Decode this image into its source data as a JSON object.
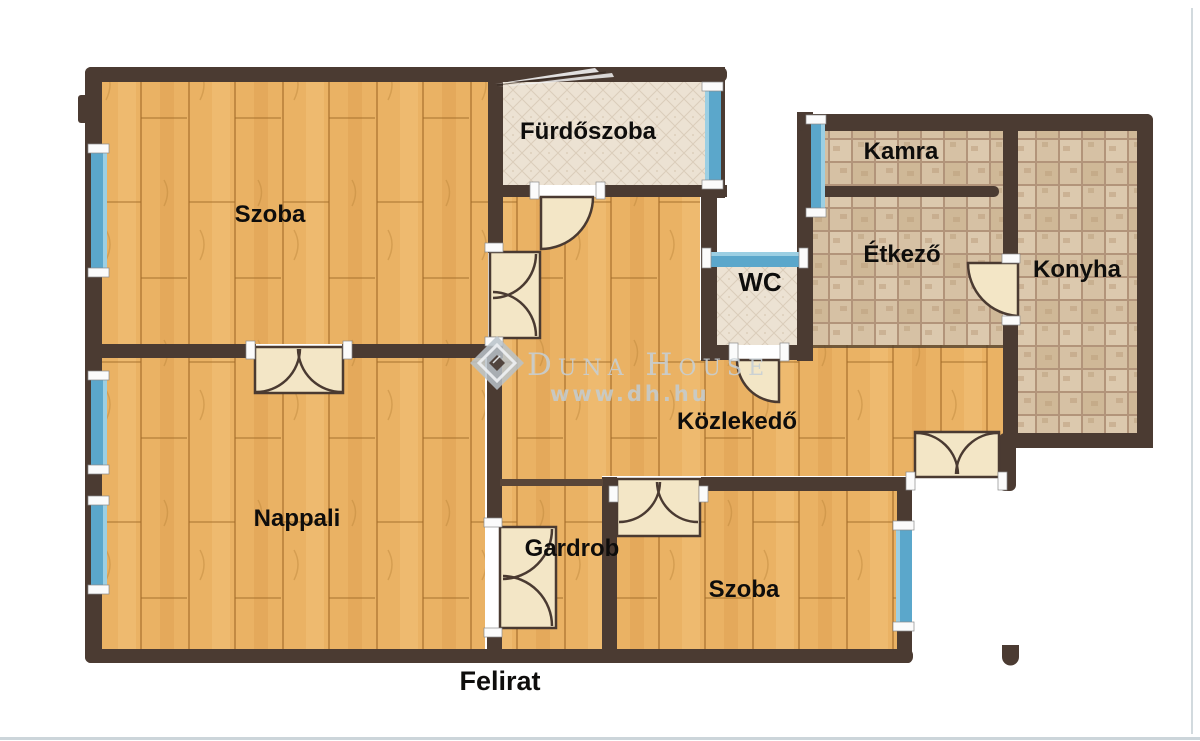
{
  "floorplan": {
    "rooms": {
      "szoba_top": "Szoba",
      "furdoszoba": "Fürdőszoba",
      "kamra": "Kamra",
      "etkezo": "Étkező",
      "konyha": "Konyha",
      "wc": "WC",
      "kozlekedo": "Közlekedő",
      "nappali": "Nappali",
      "gardrob": "Gardrob",
      "szoba_bottom": "Szoba"
    },
    "caption": "Felirat",
    "watermark": {
      "brand": "Duna House",
      "url": "www.dh.hu"
    },
    "colors": {
      "wall": "#4b3b32",
      "wood_floor": "#e9b160",
      "tile_light": "#ece1d2",
      "tile_brown": "#d6c1a4",
      "window_blue": "#5ba7cb",
      "door_cream": "#f3e6c6"
    }
  }
}
